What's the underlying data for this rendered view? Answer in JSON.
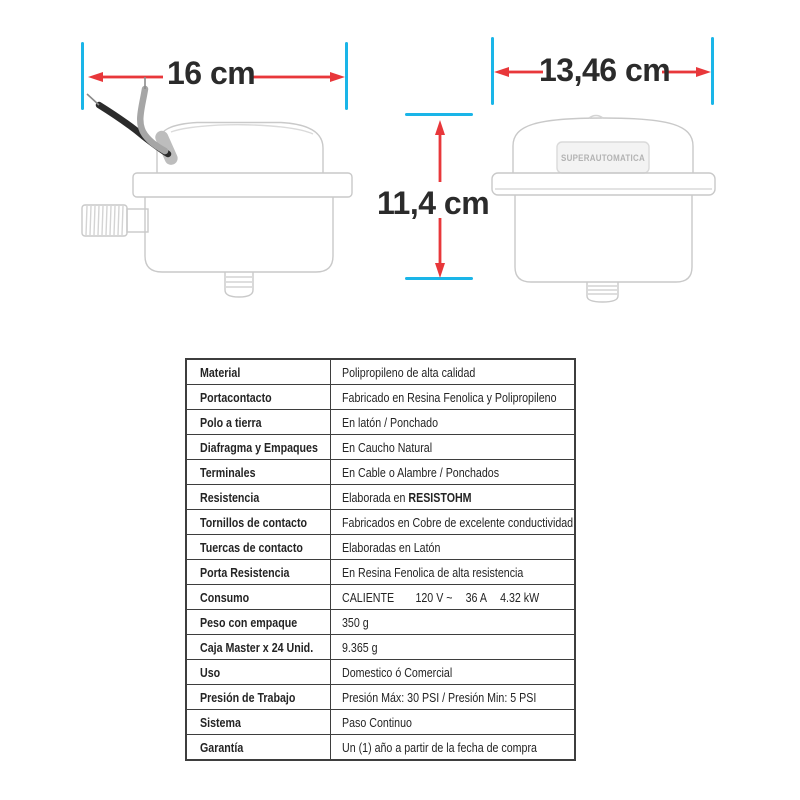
{
  "figure": {
    "left_width_label": "16 cm",
    "right_width_label": "13,46 cm",
    "height_label": "11,4 cm",
    "device_plate_label": "SUPERAUTOMATICA"
  },
  "colors": {
    "arrow_red": "#e8373a",
    "tick_cyan": "#1ab5e8"
  },
  "table": {
    "rows": [
      {
        "label": "Material",
        "value": "Polipropileno de alta calidad"
      },
      {
        "label": "Portacontacto",
        "value": "Fabricado en Resina Fenolica y Polipropileno"
      },
      {
        "label": "Polo a tierra",
        "value": "En latón / Ponchado"
      },
      {
        "label": "Diafragma y Empaques",
        "value": "En Caucho Natural"
      },
      {
        "label": "Terminales",
        "value": "En Cable o Alambre / Ponchados"
      },
      {
        "label": "Resistencia",
        "value": "Elaborada en ",
        "value_bold": "RESISTOHM"
      },
      {
        "label": "Tornillos de contacto",
        "value": "Fabricados en Cobre de excelente conductividad"
      },
      {
        "label": "Tuercas de contacto",
        "value": "Elaboradas en Latón"
      },
      {
        "label": "Porta Resistencia",
        "value": "En Resina Fenolica de alta resistencia"
      },
      {
        "label": "Consumo",
        "value_parts": [
          "CALIENTE",
          "120 V ~",
          "36 A",
          "4.32 kW"
        ]
      },
      {
        "label": "Peso con empaque",
        "value": "350 g"
      },
      {
        "label": "Caja Master x 24 Unid.",
        "value": "9.365 g"
      },
      {
        "label": "Uso",
        "value": "Domestico ó Comercial"
      },
      {
        "label": "Presión de Trabajo",
        "value": "Presión Máx: 30 PSI / Presión Min: 5 PSI"
      },
      {
        "label": "Sistema",
        "value": "Paso Continuo"
      },
      {
        "label": "Garantía",
        "value": "Un (1) año a partir de la fecha de compra"
      }
    ]
  }
}
